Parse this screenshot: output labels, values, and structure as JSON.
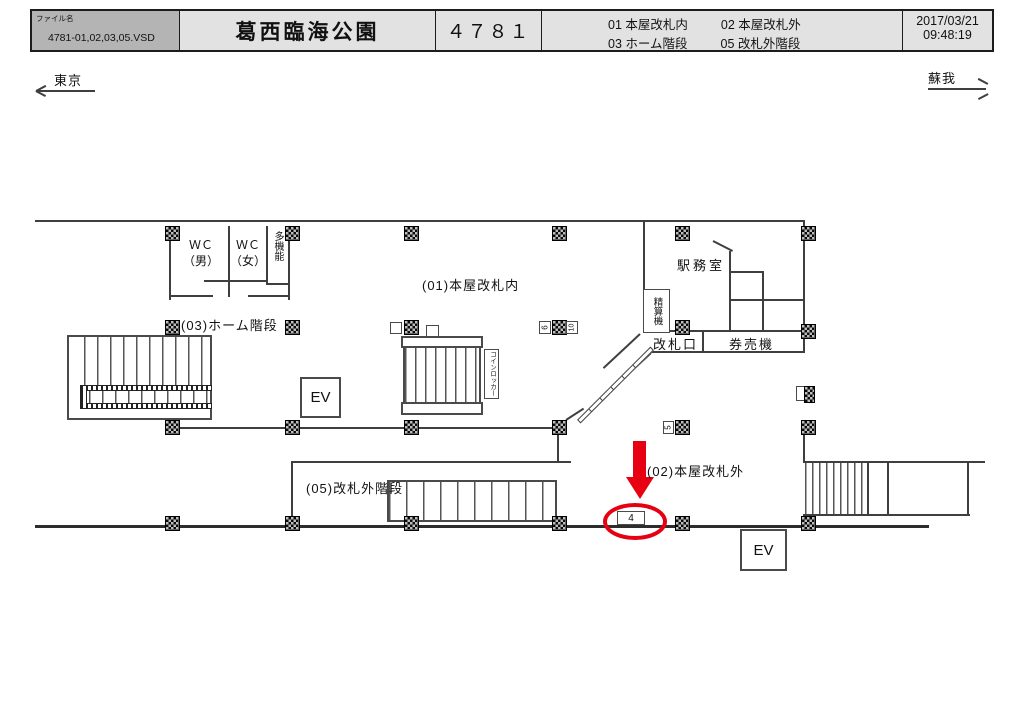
{
  "header": {
    "file_label": "ファイル名",
    "file_name": "4781-01,02,03,05.VSD",
    "station_name": "葛西臨海公園",
    "board_number": "４７８１",
    "locations": [
      {
        "code": "01",
        "name": "本屋改札内"
      },
      {
        "code": "02",
        "name": "本屋改札外"
      },
      {
        "code": "03",
        "name": "ホーム階段"
      },
      {
        "code": "05",
        "name": "改札外階段"
      }
    ],
    "date": "2017/03/21",
    "time": "09:48:19"
  },
  "directions": {
    "left": "東京",
    "right": "蘇我"
  },
  "plan": {
    "areas": {
      "a01": "(01)本屋改札内",
      "a02": "(02)本屋改札外",
      "a03": "(03)ホーム階段",
      "a05": "(05)改札外階段"
    },
    "rooms": {
      "wc_men_l1": "ＷＣ",
      "wc_men_l2": "（男）",
      "wc_women_l1": "ＷＣ",
      "wc_women_l2": "（女）",
      "multi_function": "多機能",
      "office": "駅務室",
      "fare_machine": "精算機",
      "gate": "改札口",
      "ticket_machine": "券売機",
      "coin_locker": "コインロッカー",
      "elevator": "EV"
    },
    "ad_positions": {
      "circled": "4",
      "p5": "5",
      "p6": "6",
      "p10": "10"
    },
    "colors": {
      "highlight": "#e60012",
      "wall": "#3f3f3f"
    }
  }
}
